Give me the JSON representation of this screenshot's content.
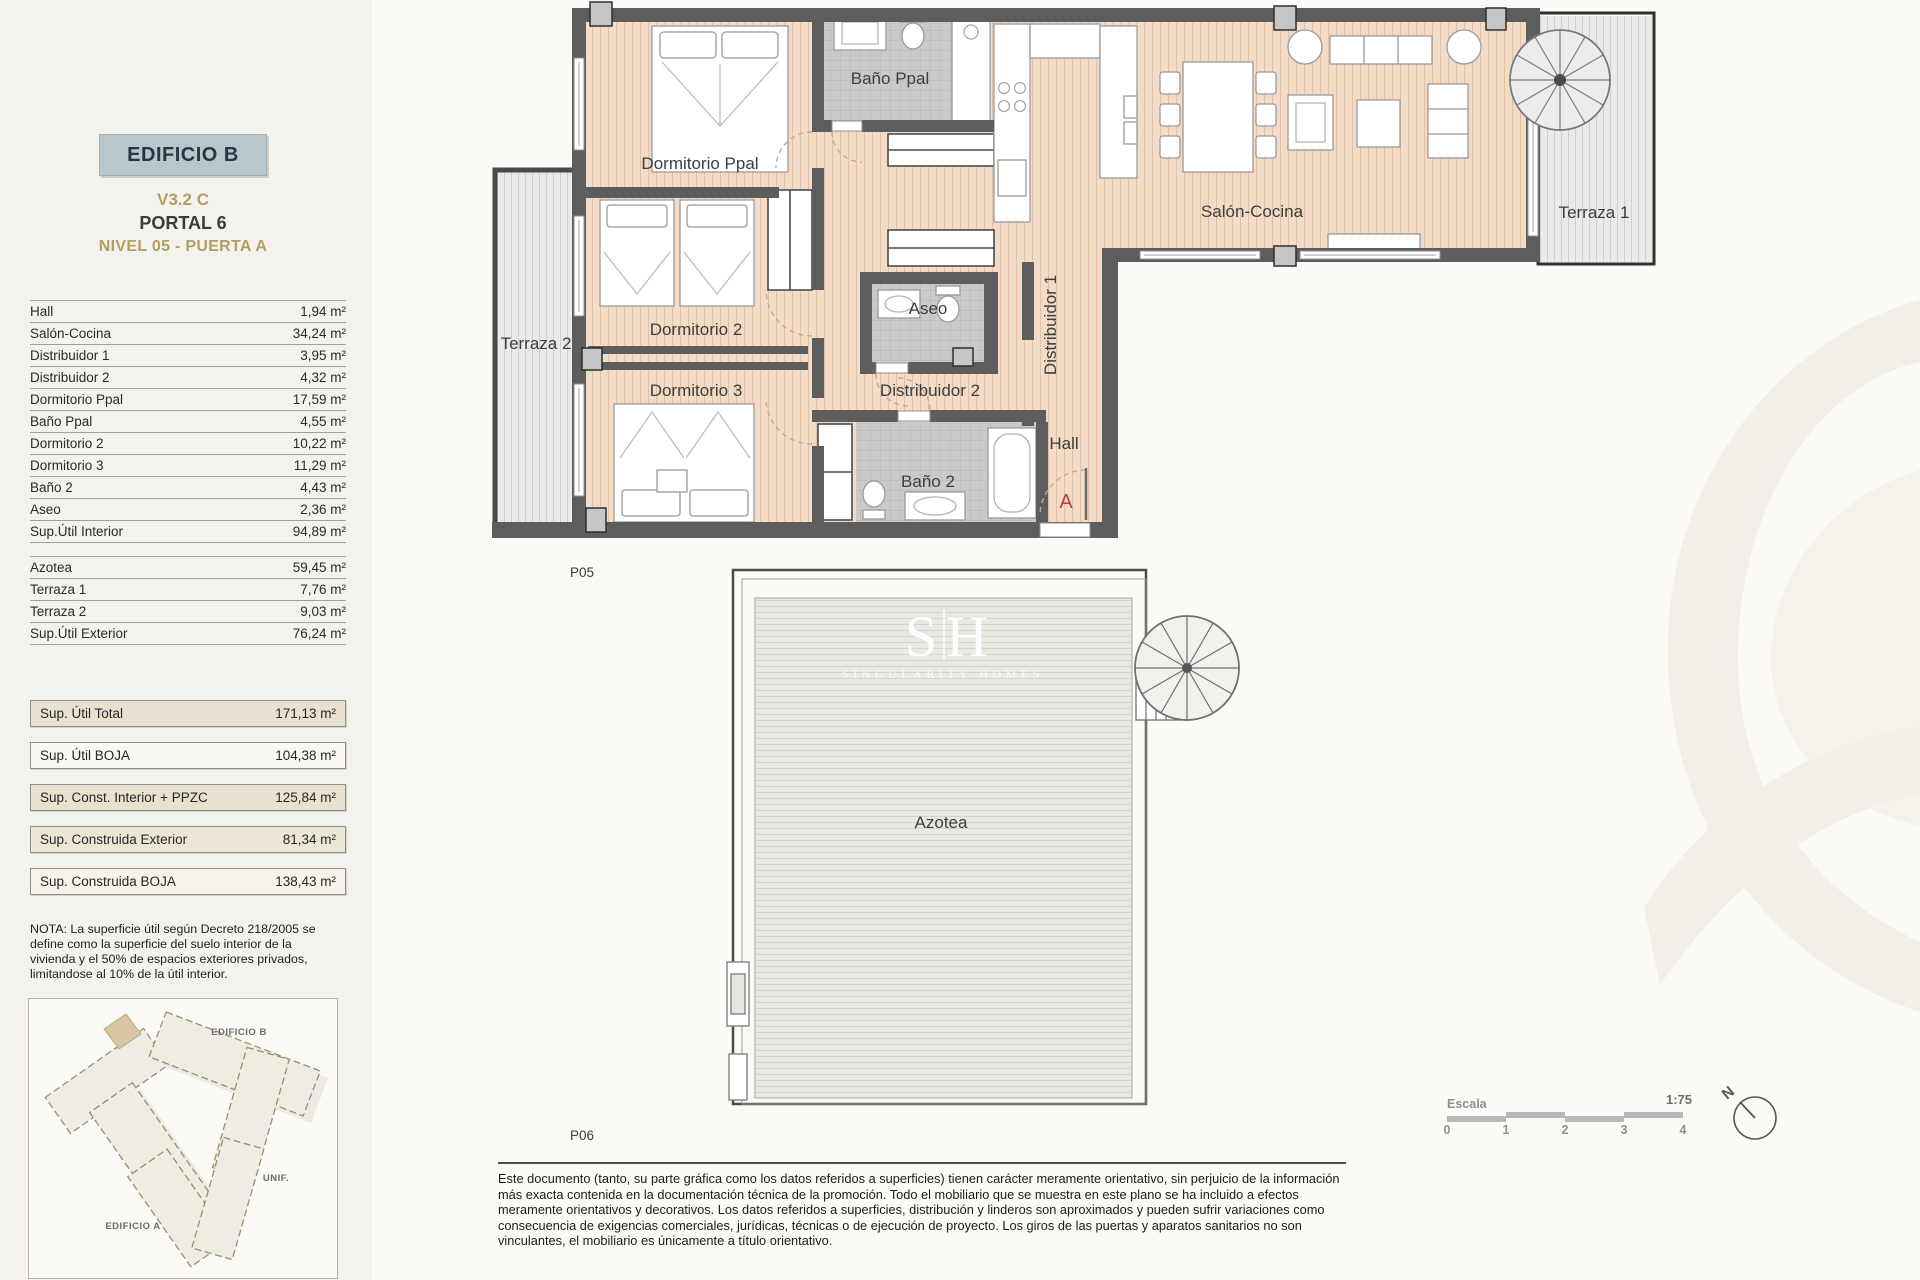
{
  "colors": {
    "header_box_bg": "#b9c6ca",
    "accent_gold": "#b49d62",
    "entrance_marker_red": "#b5433a",
    "wood_floor": "#f3dcc7",
    "bath_tile": "#cacaca",
    "terrace_deck": "#eaeaea",
    "roof_deck": "#eae8e3"
  },
  "header": {
    "building": "EDIFICIO B",
    "version": "V3.2 C",
    "portal": "PORTAL 6",
    "level": "NIVEL 05 - PUERTA A"
  },
  "areas_interior": {
    "rows": [
      {
        "label": "Hall",
        "value": "1,94 m²"
      },
      {
        "label": "Salón-Cocina",
        "value": "34,24 m²"
      },
      {
        "label": "Distribuidor 1",
        "value": "3,95 m²"
      },
      {
        "label": "Distribuidor 2",
        "value": "4,32 m²"
      },
      {
        "label": "Dormitorio Ppal",
        "value": "17,59 m²"
      },
      {
        "label": "Baño Ppal",
        "value": "4,55 m²"
      },
      {
        "label": "Dormitorio 2",
        "value": "10,22 m²"
      },
      {
        "label": "Dormitorio 3",
        "value": "11,29 m²"
      },
      {
        "label": "Baño 2",
        "value": "4,43 m²"
      },
      {
        "label": "Aseo",
        "value": "2,36 m²"
      },
      {
        "label": "Sup.Útil Interior",
        "value": "94,89 m²"
      }
    ]
  },
  "areas_exterior": {
    "rows": [
      {
        "label": "Azotea",
        "value": "59,45 m²"
      },
      {
        "label": "Terraza 1",
        "value": "7,76 m²"
      },
      {
        "label": "Terraza 2",
        "value": "9,03 m²"
      },
      {
        "label": "Sup.Útil Exterior",
        "value": "76,24 m²"
      }
    ]
  },
  "summary": {
    "rows": [
      {
        "label": "Sup. Útil Total",
        "value": "171,13 m²"
      },
      {
        "label": "Sup. Útil BOJA",
        "value": "104,38 m²"
      },
      {
        "label": "Sup. Const. Interior + PPZC",
        "value": "125,84 m²"
      },
      {
        "label": "Sup. Construida Exterior",
        "value": "81,34 m²"
      },
      {
        "label": "Sup. Construida BOJA",
        "value": "138,43 m²"
      }
    ]
  },
  "nota": "NOTA: La superficie útil según Decreto 218/2005 se define como la superficie del suelo interior de la vivienda y el 50% de espacios exteriores privados, limitandose al 10% de la útil interior.",
  "siteplan": {
    "edificio_b": "EDIFICIO B",
    "unif": "UNIF.",
    "edificio_a": "EDIFICIO A"
  },
  "plan": {
    "sheet": "P05",
    "entrance_letter": "A",
    "rooms": {
      "bano_ppal": "Baño Ppal",
      "dormitorio_ppal": "Dormitorio Ppal",
      "dormitorio_2": "Dormitorio 2",
      "dormitorio_3": "Dormitorio 3",
      "terraza_2": "Terraza 2",
      "salon_cocina": "Salón-Cocina",
      "terraza_1": "Terraza 1",
      "aseo": "Aseo",
      "distribuidor_1": "Distribuidor 1",
      "distribuidor_2": "Distribuidor 2",
      "hall": "Hall",
      "bano_2": "Baño 2"
    }
  },
  "roof": {
    "sheet": "P06",
    "label": "Azotea",
    "watermark_initial_left": "S",
    "watermark_initial_right": "H",
    "watermark_name": "SINGULARITY HOMES"
  },
  "scalebar": {
    "label": "Escala",
    "ratio": "1:75",
    "ticks": [
      "0",
      "1",
      "2",
      "3",
      "4"
    ]
  },
  "north_label": "N",
  "disclaimer": "Este documento (tanto, su parte gráfica como los datos referidos a superficies) tienen carácter meramente orientativo, sin perjuicio de la información más exacta contenida en la documentación técnica de la promoción. Todo el mobiliario que se muestra en este plano se ha incluido a efectos meramente orientativos y decorativos. Los datos referidos a superficies, distribución y linderos son aproximados y pueden sufrir variaciones como consecuencia de exigencias comerciales, jurídicas, técnicas o de ejecución de proyecto. Los giros de las puertas y aparatos sanitarios no son vinculantes, el mobiliario es únicamente a título orientativo."
}
